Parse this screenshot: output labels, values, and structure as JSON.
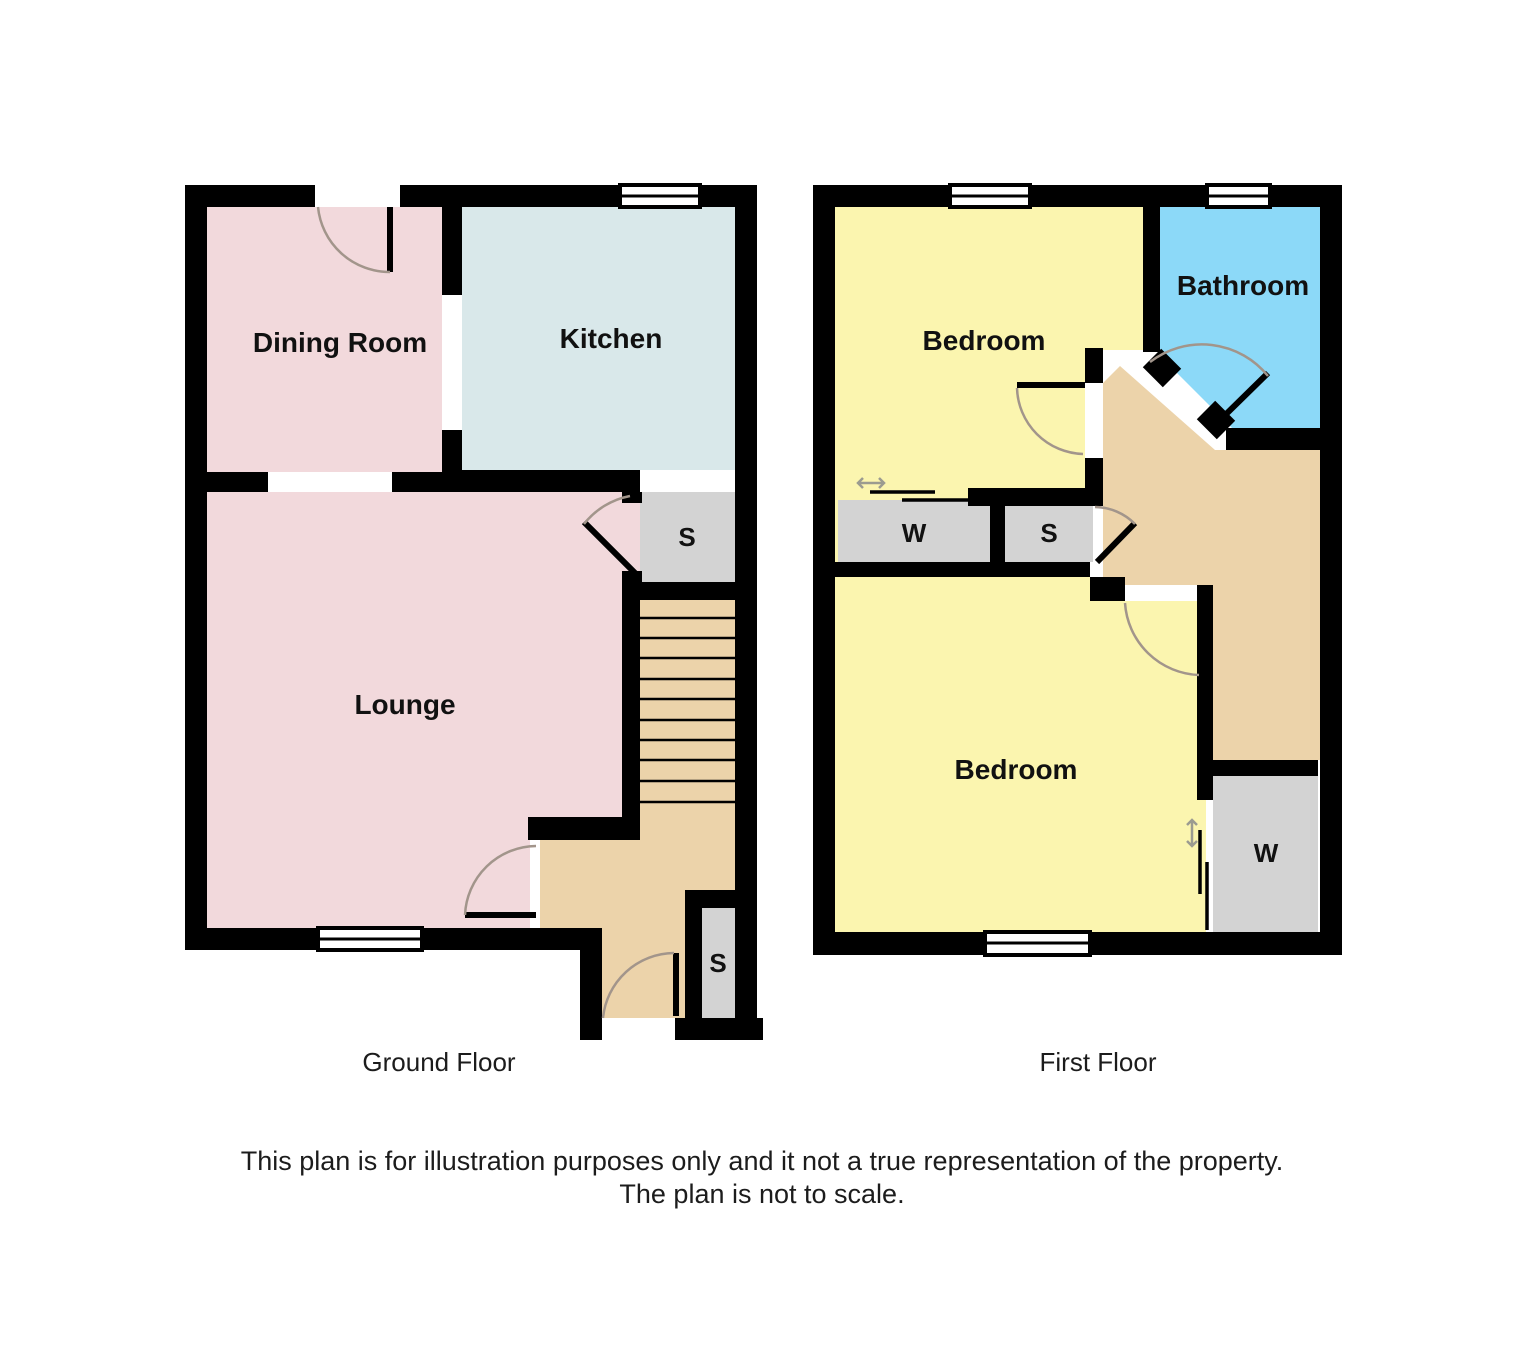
{
  "colors": {
    "wall": "#000000",
    "pink": "#f2d9dc",
    "kitchen_blue": "#d9e8ea",
    "yellow": "#fbf5af",
    "bathroom_blue": "#8cd9f8",
    "tan": "#ecd3aa",
    "closet_gray": "#d3d3d3",
    "window_white": "#ffffff",
    "arc": "#a2958b",
    "arrow": "#9b9b90",
    "label": "#111111",
    "caption": "#1c1c1c"
  },
  "ground_floor": {
    "caption": "Ground Floor",
    "dining": "Dining Room",
    "kitchen": "Kitchen",
    "lounge": "Lounge",
    "storage_mid": "S",
    "storage_entry": "S"
  },
  "first_floor": {
    "caption": "First Floor",
    "bedroom_front": "Bedroom",
    "bathroom": "Bathroom",
    "wardrobe_front": "W",
    "storage_landing": "S",
    "bedroom_back": "Bedroom",
    "wardrobe_back": "W"
  },
  "disclaimer": {
    "line1": "This plan is for illustration purposes only and it not a true representation of the property.",
    "line2": "The plan is not to scale."
  }
}
